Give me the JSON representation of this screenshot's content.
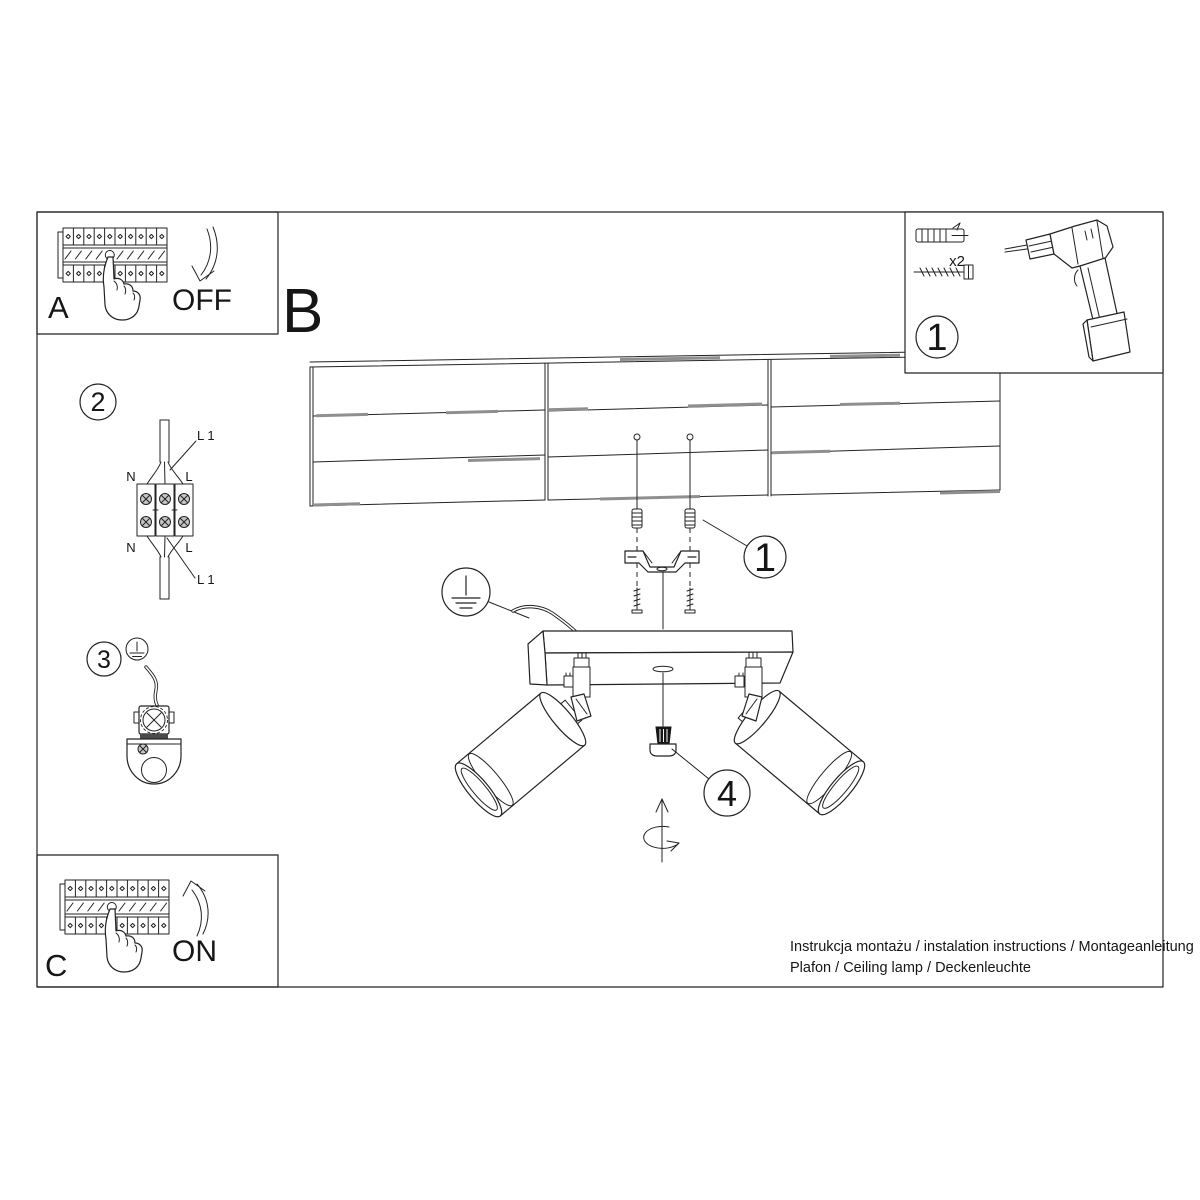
{
  "sections": {
    "a": {
      "label": "A",
      "action": "OFF"
    },
    "b": {
      "label": "B"
    },
    "c": {
      "label": "C",
      "action": "ON"
    }
  },
  "callouts": {
    "kit": "1",
    "wiring": "2",
    "ground": "3",
    "bracket": "1",
    "knob": "4"
  },
  "kit": {
    "quantity": "x2"
  },
  "wiring_labels": {
    "neutral_top": "N",
    "line_top": "L",
    "l1_top": "L 1",
    "neutral_bottom": "N",
    "line_bottom": "L",
    "l1_bottom": "L 1"
  },
  "footer": {
    "line1": "Instrukcja montażu / instalation instructions / Montageanleitung",
    "line2": "Plafon / Ceiling lamp / Deckenleuchte"
  },
  "colors": {
    "line": "#232323",
    "plank_gray": "#8f8f8f",
    "screw_gray": "#c6c6c6"
  }
}
